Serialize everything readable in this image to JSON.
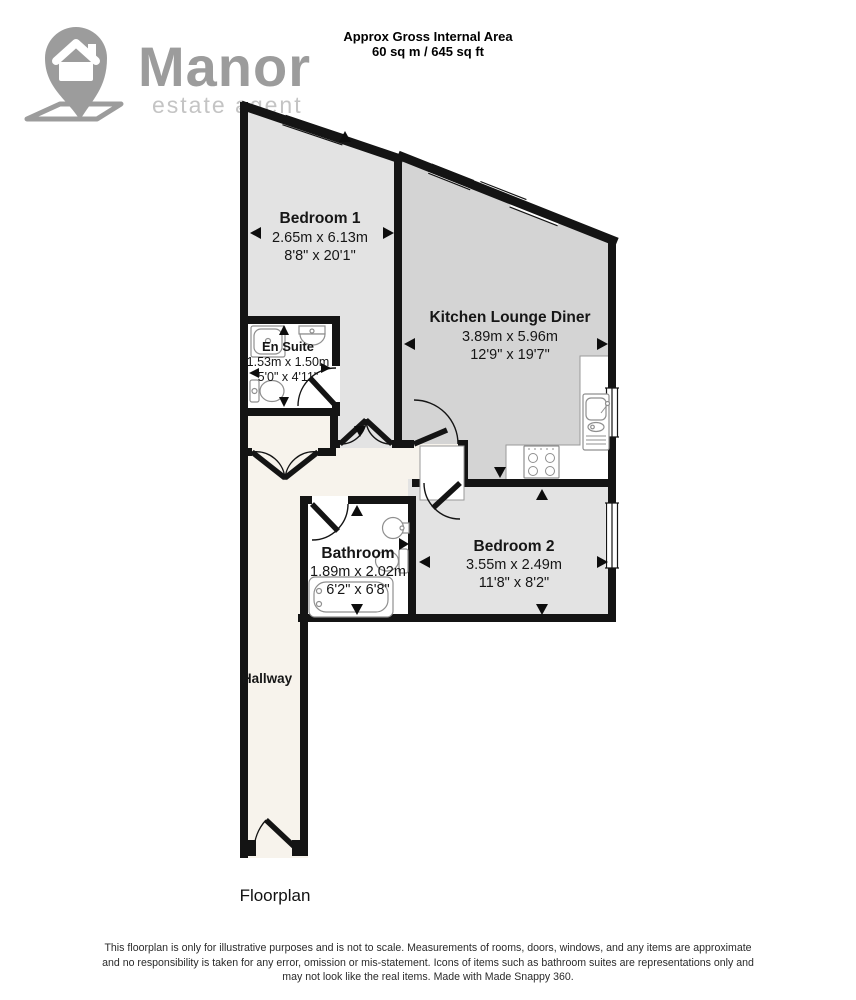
{
  "header": {
    "title": "Approx Gross Internal Area",
    "area": "60 sq m / 645 sq ft"
  },
  "logo": {
    "brand": "Manor",
    "tagline": "estate agent"
  },
  "rooms": {
    "bedroom1": {
      "name": "Bedroom 1",
      "metric": "2.65m x 6.13m",
      "imperial": "8'8\" x 20'1\""
    },
    "kitchen": {
      "name": "Kitchen Lounge Diner",
      "metric": "3.89m x 5.96m",
      "imperial": "12'9\" x 19'7\""
    },
    "ensuite": {
      "name": "En Suite",
      "metric": "1.53m x 1.50m",
      "imperial": "5'0\" x 4'11\""
    },
    "bathroom": {
      "name": "Bathroom",
      "metric": "1.89m x 2.02m",
      "imperial": "6'2\" x 6'8\""
    },
    "bedroom2": {
      "name": "Bedroom 2",
      "metric": "3.55m x 2.49m",
      "imperial": "11'8\" x 8'2\""
    },
    "hallway": {
      "name": "Hallway"
    }
  },
  "caption": "Floorplan",
  "disclaimer": {
    "line1": "This floorplan is only for illustrative purposes and is not to scale. Measurements of rooms, doors, windows, and any items are approximate",
    "line2": "and no responsibility is taken for any error, omission or mis-statement. Icons of items such as bathroom suites are representations only and",
    "line3": "may not look like the real items. Made with Made Snappy 360."
  },
  "colors": {
    "wall": "#141414",
    "bedroom_floor": "#e3e3e3",
    "kitchen_floor": "#d4d4d4",
    "hallway_floor": "#f7f3ec",
    "wet_room_floor": "#ffffff",
    "logo_gray": "#9c9c9c",
    "logo_light_gray": "#c4c4c4"
  }
}
